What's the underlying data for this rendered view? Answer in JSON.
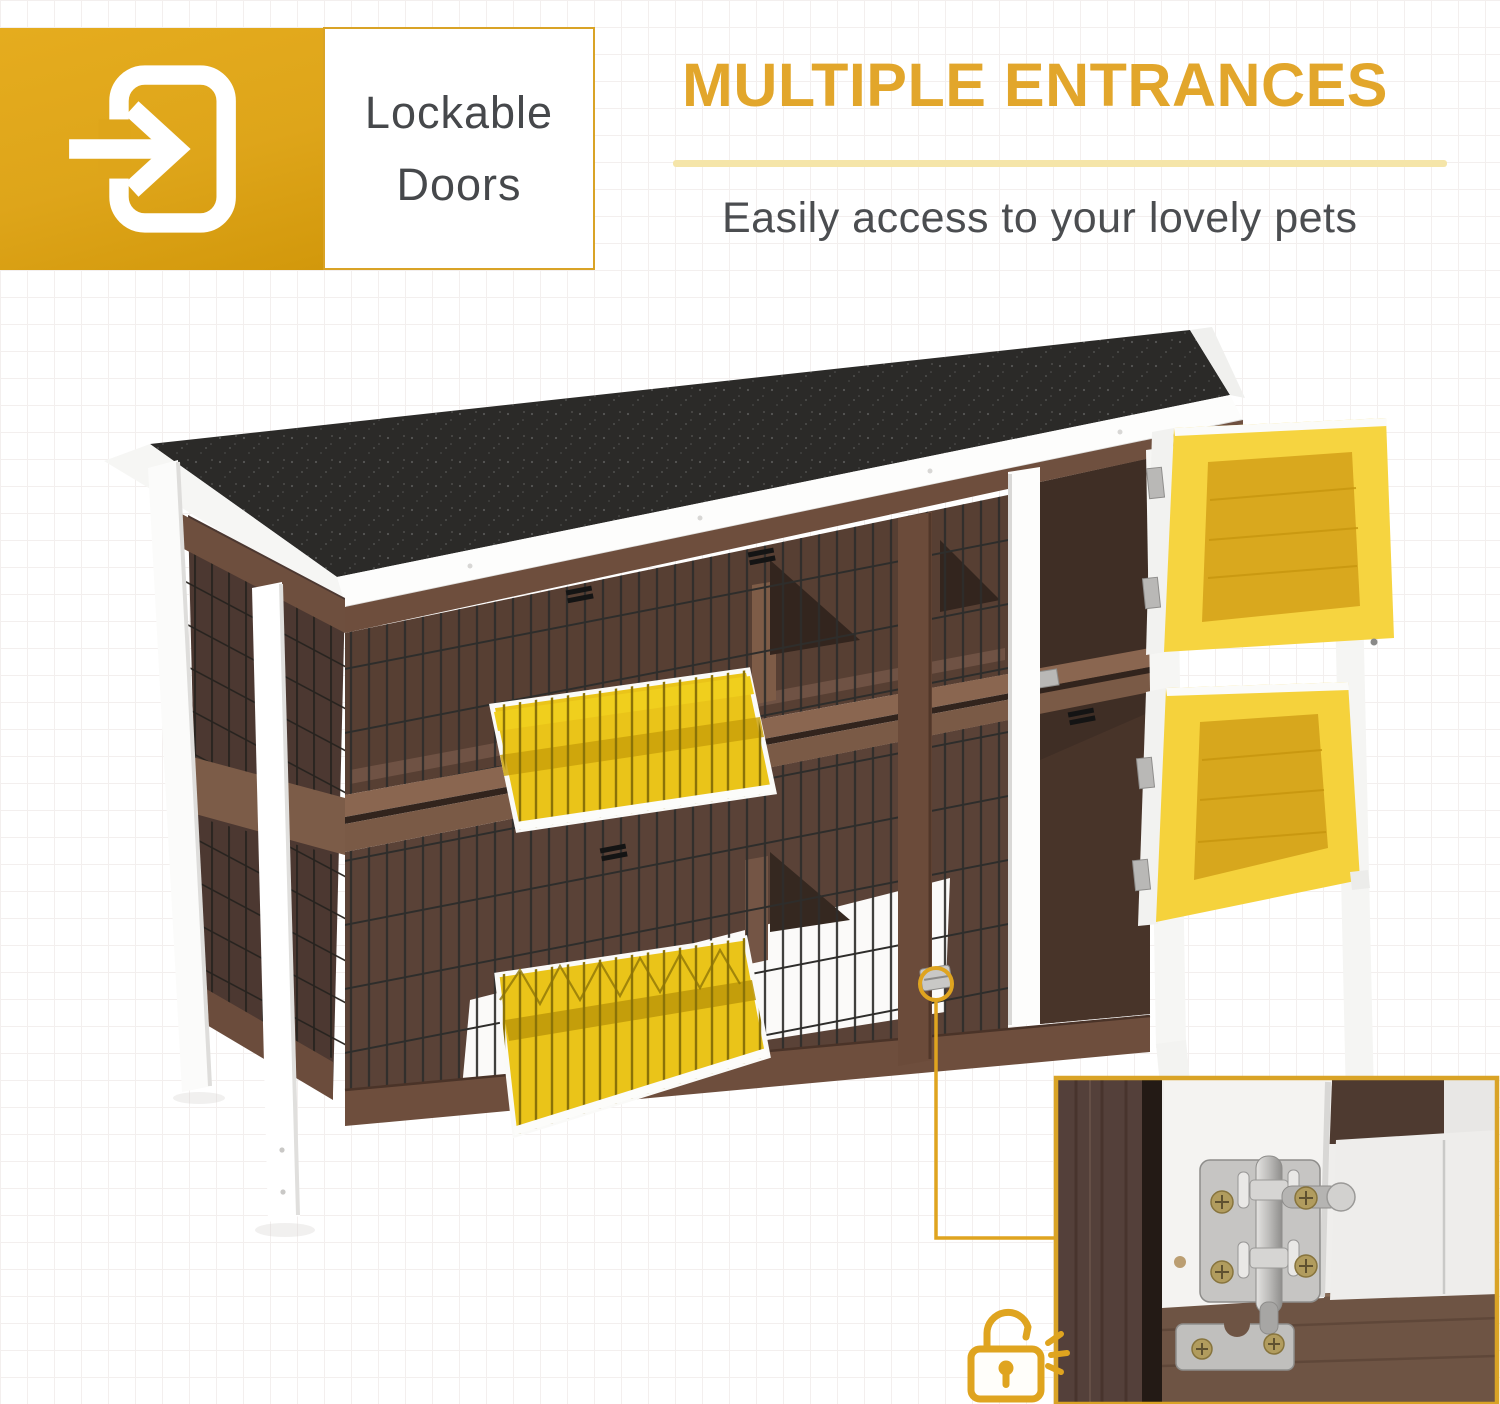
{
  "badge": {
    "icon": "door-enter-arrow-icon",
    "label_line1": "Lockable",
    "label_line2": "Doors"
  },
  "headline": {
    "title": "MULTIPLE ENTRANCES",
    "subtitle": "Easily access to your lovely pets"
  },
  "callout": {
    "icon": "open-padlock-icon"
  },
  "colors": {
    "accent_gold": "#DFA41F",
    "title_gold": "#E2A62B",
    "divider_pale": "#F5E5A9",
    "badge_yellow": "#DEA51A",
    "label_gray": "#46484B",
    "subtitle_gray": "#4B4D50",
    "door_frame_yellow": "#F5D23C",
    "door_panel_yellow": "#D8A81E",
    "flap_yellow": "#EAC419",
    "wood_dark": "#573F33",
    "wood_mid": "#6E4E3D",
    "wood_rail": "#8A6650",
    "roof_black": "#2B2A28",
    "frame_white": "#F6F6F4",
    "metal_gray": "#C6C5C3"
  }
}
